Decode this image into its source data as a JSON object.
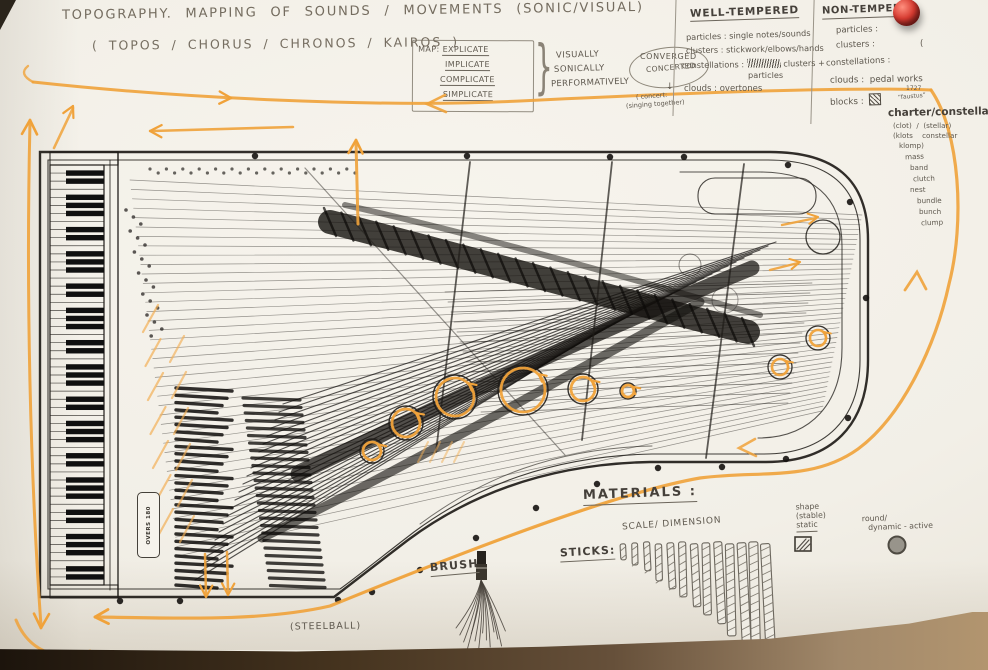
{
  "colors": {
    "marker_orange": "#f0a23a",
    "pencil": "#5e584e",
    "ink": "#1f1c18",
    "paper": "#f3f0e9",
    "table_brown": "#3c2e1f",
    "cork_tan": "#b2956f",
    "pin_red": "#c22a28"
  },
  "title": {
    "line1": "TOPOGRAPHY.  MAPPING  OF  SOUNDS  / MOVEMENTS  (SONIC/VISUAL)",
    "line2": "( TOPOS / CHORUS / CHRONOS / KAIROS )"
  },
  "map_box": {
    "heading": "MAP:",
    "items": [
      "EXPLICATE",
      "IMPLICATE",
      "COMPLICATE",
      "SIMPLICATE"
    ],
    "modes": [
      "VISUALLY",
      "SONICALLY",
      "PERFORMATIVELY"
    ],
    "result_top": "CONVERGED",
    "result_bottom": "CONCERTED",
    "down_arrow": "↓",
    "note_line1": "( concert:",
    "note_line2": "(singing together)"
  },
  "well_tempered": {
    "heading": "WELL-TEMPERED",
    "line1_label": "particles :",
    "line1_value": "single notes/sounds",
    "line2_label": "clusters :",
    "line2_value": "stickwork/elbows/hands",
    "line3_label": "constellations :",
    "line3_value": "clusters +",
    "line3_value2": "particles",
    "line4_label": "clouds :",
    "line4_value": "overtones"
  },
  "non_tempered": {
    "heading": "NON-TEMPERED",
    "line1": "particles :",
    "line2": "clusters :",
    "line2_extra": "(",
    "line3": "constellations :",
    "line4_label": "clouds :",
    "line4_value": "pedal works",
    "line5_label": "blocks :",
    "blocks_year": "1727",
    "blocks_note": "“faustus”",
    "charter": "charter/constellation",
    "sub_left1": "(clot)",
    "sub_sep": "/",
    "sub_right1": "(stellar)",
    "sub_left2": "(klots",
    "sub_right2": "constellar",
    "sub_left3": "klomp)",
    "synonyms": [
      "mass",
      "band",
      "clutch",
      "nest",
      "bundle",
      "bunch",
      "clump"
    ]
  },
  "materials": {
    "heading": "MATERIALS :",
    "scale_label": "SCALE/ DIMENSION",
    "sticks_label": "STICKS:",
    "shape_line1": "shape",
    "shape_line2": "(stable)",
    "shape_line3": "static",
    "round_line1": "round/",
    "round_line2": "dynamic - active",
    "brush_label": "BRUSH",
    "steelball_label": "(STEELBALL)"
  },
  "piano": {
    "plate_label": "OVERS 180"
  },
  "sticks": {
    "count": 13,
    "heights": [
      16,
      22,
      29,
      37,
      46,
      55,
      63,
      72,
      82,
      92,
      103,
      114,
      126
    ]
  }
}
